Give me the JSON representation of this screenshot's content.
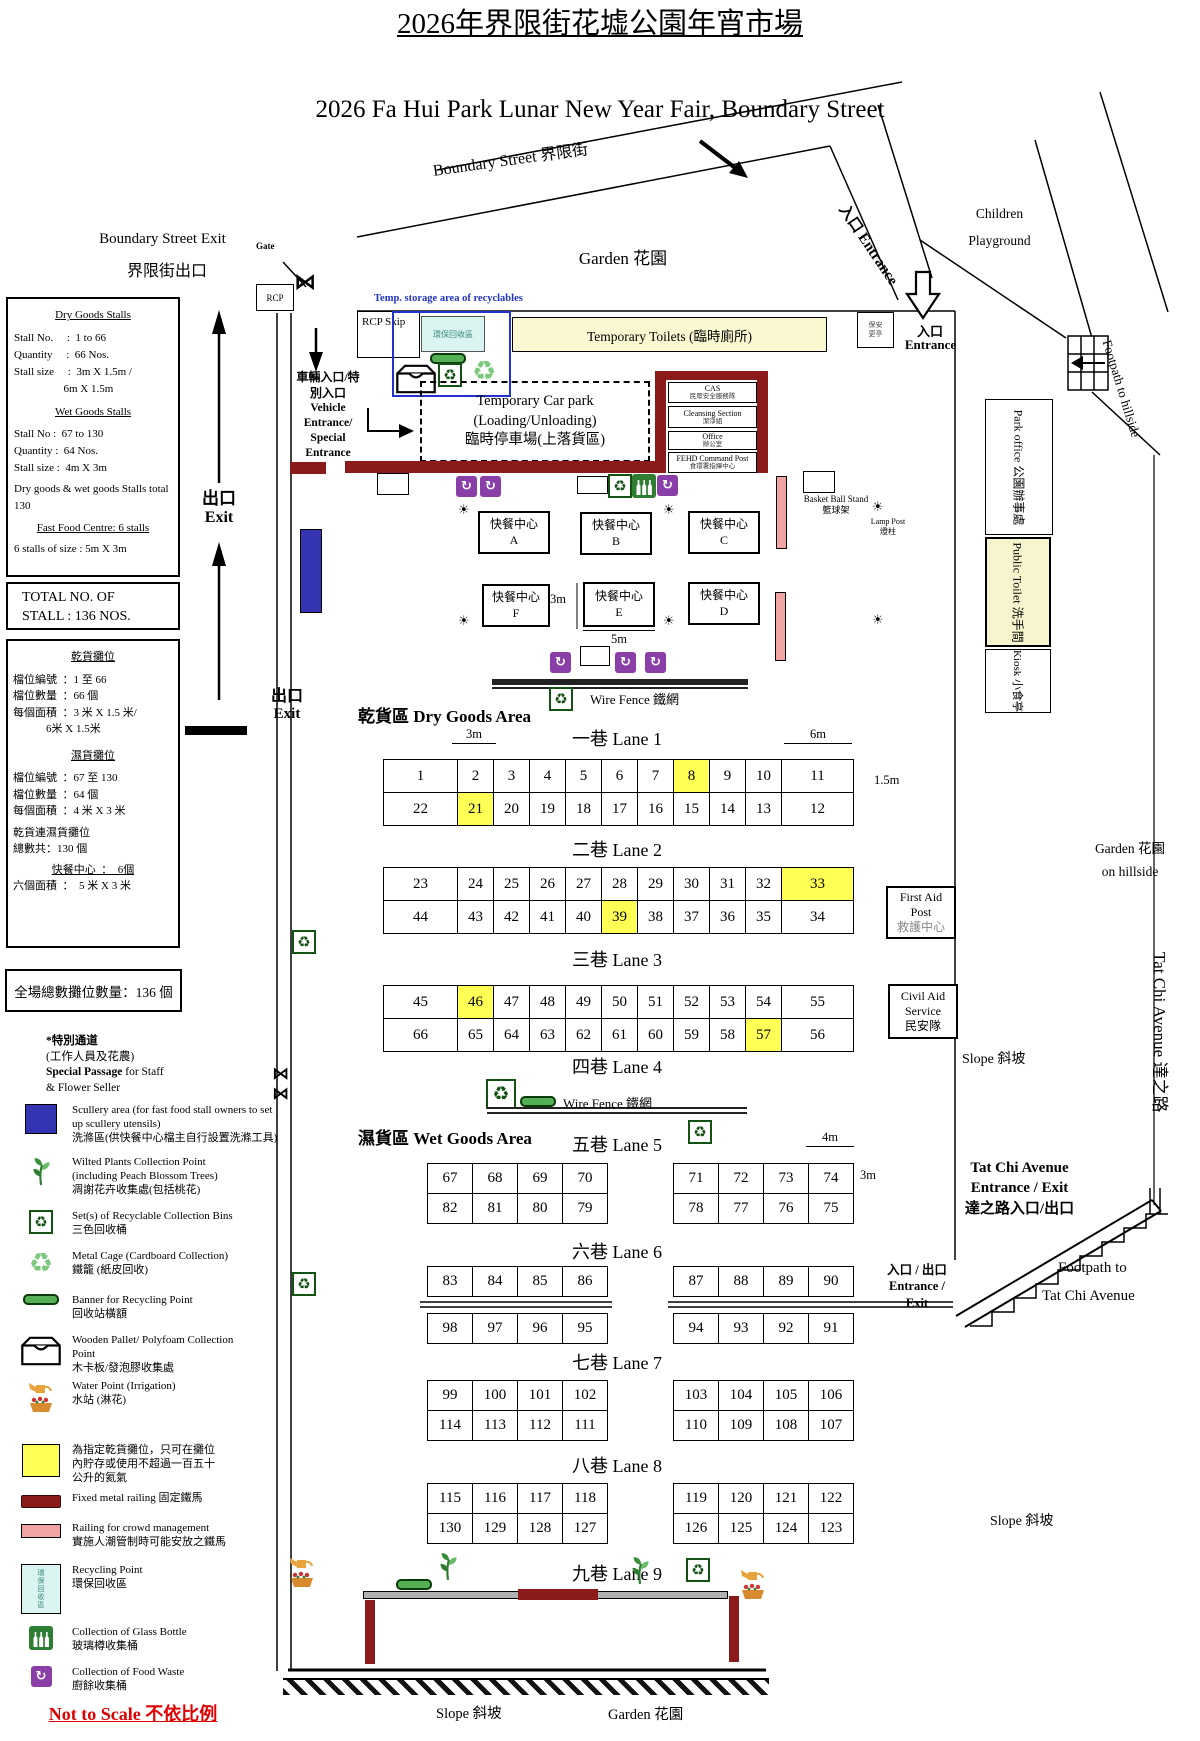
{
  "header": {
    "title_zh": "2026年界限街花墟公園年宵市場",
    "title_en": "2026 Fa Hui Park Lunar New Year Fair, Boundary Street"
  },
  "streets": {
    "boundary": "Boundary Street 界限街",
    "exit_en": "Boundary Street Exit",
    "exit_zh": "界限街出口",
    "gate": "Gate",
    "rcp": "RCP"
  },
  "left": {
    "dry_box": {
      "h1": "Dry Goods Stalls",
      "l1": "Stall No.     :  1 to 66",
      "l2": "Quantity     :  66 Nos.",
      "l3": "Stall size     :  3m X 1.5m /",
      "l4": "                  6m X 1.5m",
      "h2": "Wet Goods Stalls",
      "l5": "Stall No :  67 to 130",
      "l6": "Quantity :  64 Nos.",
      "l7": "Stall size :  4m X 3m",
      "l8": "Dry goods & wet goods Stalls total",
      "l9": "130",
      "h3": "Fast Food Centre: 6 stalls",
      "l10": "6 stalls of size : 5m X 3m"
    },
    "total_box": {
      "l1": "TOTAL NO. OF",
      "l2": "STALL : 136 NOS."
    },
    "zh_box": {
      "h1": "乾貨攤位",
      "l1": "檔位編號  ：1 至 66",
      "l2": "檔位數量  ：66 個",
      "l3": "每個面積  ：3 米 X 1.5 米/",
      "l4": "            6米 X 1.5米",
      "h2": "濕貨攤位",
      "l5": "檔位編號  ：67 至 130",
      "l6": "檔位數量  ：64 個",
      "l7": "每個面積  ：4 米 X 3 米",
      "l8": "乾貨連濕貨攤位",
      "l9": "總數共：130 個",
      "h3": "快餐中心  ：  6個",
      "l10": "六個面積  ：  5 米 X 3 米"
    },
    "grand_total": "全場總數攤位數量：136 個",
    "special": {
      "l1": "*特別通道",
      "l2": "(工作人員及花農)",
      "l3b": "Special Passage",
      "l3r": " for Staff",
      "l4": "& Flower Seller"
    },
    "legend": [
      {
        "icon": "scullery",
        "lines": [
          "Scullery area (for fast food stall owners to set",
          "up scullery utensils)",
          "洗滌區(供快餐中心檔主自行設置洗滌工具)"
        ]
      },
      {
        "icon": "plant",
        "lines": [
          "Wilted Plants Collection Point",
          "(including Peach Blossom Trees)",
          "凋謝花卉收集處(包括桃花)"
        ]
      },
      {
        "icon": "bins",
        "lines": [
          "Set(s) of Recyclable Collection Bins",
          "三色回收桶"
        ]
      },
      {
        "icon": "cage",
        "lines": [
          "Metal Cage (Cardboard Collection)",
          "鐵籠 (紙皮回收)"
        ]
      },
      {
        "icon": "banner",
        "lines": [
          "Banner for Recycling Point",
          "回收站橫額"
        ]
      },
      {
        "icon": "pallet",
        "lines": [
          "Wooden Pallet/ Polyfoam Collection",
          "Point",
          "木卡板/發泡膠收集處"
        ]
      },
      {
        "icon": "water",
        "lines": [
          "Water Point (Irrigation)",
          "水站 (淋花)"
        ]
      },
      {
        "icon": "yellow",
        "lines": [
          "為指定乾貨攤位，只可在攤位",
          "內貯存或使用不超過一百五十",
          "公升的氦氣"
        ]
      },
      {
        "icon": "railing-dark",
        "lines": [
          "Fixed metal railing 固定鐵馬"
        ]
      },
      {
        "icon": "railing-pink",
        "lines": [
          "Railing for crowd management",
          "實施人潮管制時可能安放之鐵馬"
        ]
      },
      {
        "icon": "recycling-point",
        "box_text": "環保回收區",
        "lines": [
          "Recycling Point",
          "環保回收區"
        ]
      },
      {
        "icon": "glass",
        "lines": [
          "Collection of Glass Bottle",
          "玻璃樽收集桶"
        ]
      },
      {
        "icon": "waste",
        "lines": [
          "Collection of Food Waste",
          "廚餘收集桶"
        ]
      }
    ],
    "not_to_scale": "Not to Scale 不依比例"
  },
  "exits": {
    "e1_zh": "出口",
    "e1_en": "Exit",
    "e2_zh": "出口",
    "e2_en": "Exit"
  },
  "map": {
    "temp_storage": "Temp. storage area of recyclables",
    "rcp_skip": "RCP Skip",
    "recycle_zone": "環保回收區",
    "garden": "Garden 花園",
    "toilets": "Temporary Toilets (臨時廁所)",
    "vehicle": {
      "z1": "車輛入口/特",
      "z2": "別入口",
      "e1": "Vehicle",
      "e2": "Entrance/",
      "e3": "Special",
      "e4": "Entrance"
    },
    "carpark": {
      "l1": "Temporary Car park",
      "l2": "(Loading/Unloading)",
      "l3": "臨時停車場(上落貨區)"
    },
    "cas": [
      {
        "en": "CAS",
        "zh": "民眾安全服務隊"
      },
      {
        "en": "Cleansing Section",
        "zh": "潔淨組"
      },
      {
        "en": "Office",
        "zh": "辦公室"
      },
      {
        "en": "FEHD Command Post",
        "zh": "食環署指揮中心"
      }
    ],
    "security": {
      "l1": "保安",
      "l2": "更亭"
    },
    "entrance_road": "入口 Entrance",
    "entrance": {
      "zh": "入口",
      "en": "Entrance"
    },
    "children": {
      "l1": "Children",
      "l2": "Playground"
    },
    "footpath_hillside": "Footpath to hillside",
    "park_office": "Park office 公園辦事處",
    "public_toilet": "Public Toilet 洗手間",
    "kiosk": "Kiosk 小食亭",
    "lamp_post": {
      "l1": "Lamp Post",
      "l2": "燈柱"
    },
    "basketball": {
      "l1": "Basket Ball Stand",
      "l2": "籃球架"
    },
    "first_aid": {
      "l1": "First Aid",
      "l2": "Post",
      "l3": "救護中心"
    },
    "civil_aid": {
      "l1": "Civil Aid",
      "l2": "Service",
      "l3": "民安隊"
    },
    "slope_a": "Slope 斜坡",
    "slope_b": "Slope 斜坡",
    "slope_c": "Slope 斜坡",
    "garden_hillside": {
      "l1": "Garden 花園",
      "l2": "on hillside"
    },
    "tatchi_entrance": {
      "l1": "Tat Chi Avenue",
      "l2": "Entrance / Exit",
      "l3": "達之路入口/出口"
    },
    "entrance_exit": {
      "l1": "入口 / 出口",
      "l2": "Entrance /",
      "l3": "Exit"
    },
    "footpath_tatchi": {
      "l1": "Footpath to",
      "l2": "Tat Chi Avenue"
    },
    "tatchi_vert": "Tat Chi Avenue 達之路",
    "dry_area": "乾貨區 Dry Goods Area",
    "wet_area": "濕貨區 Wet Goods Area",
    "wire_fence1": "Wire Fence 鐵網",
    "wire_fence2": "Wire Fence 鐵網",
    "garden_bottom": "Garden 花園",
    "dims": {
      "d3a": "3m",
      "d6": "6m",
      "d15": "1.5m",
      "d3f": "3m",
      "d5": "5m",
      "d4": "4m",
      "d3w": "3m"
    },
    "fast_food": [
      {
        "t": "快餐中心",
        "l": "A"
      },
      {
        "t": "快餐中心",
        "l": "B"
      },
      {
        "t": "快餐中心",
        "l": "C"
      },
      {
        "t": "快餐中心",
        "l": "F"
      },
      {
        "t": "快餐中心",
        "l": "E"
      },
      {
        "t": "快餐中心",
        "l": "D"
      }
    ]
  },
  "lanes": {
    "labels": [
      "一巷 Lane 1",
      "二巷 Lane 2",
      "三巷 Lane 3",
      "四巷 Lane 4",
      "五巷 Lane 5",
      "六巷 Lane 6",
      "七巷 Lane 7",
      "八巷 Lane 8",
      "九巷 Lane 9"
    ],
    "dry": [
      {
        "rows": [
          [
            "1",
            "2",
            "3",
            "4",
            "5",
            "6",
            "7",
            "8",
            "9",
            "10",
            "11"
          ],
          [
            "22",
            "21",
            "20",
            "19",
            "18",
            "17",
            "16",
            "15",
            "14",
            "13",
            "12"
          ]
        ],
        "yellow": [
          "8",
          "21"
        ]
      },
      {
        "rows": [
          [
            "23",
            "24",
            "25",
            "26",
            "27",
            "28",
            "29",
            "30",
            "31",
            "32",
            "33"
          ],
          [
            "44",
            "43",
            "42",
            "41",
            "40",
            "39",
            "38",
            "37",
            "36",
            "35",
            "34"
          ]
        ],
        "yellow": [
          "33",
          "39"
        ]
      },
      {
        "rows": [
          [
            "45",
            "46",
            "47",
            "48",
            "49",
            "50",
            "51",
            "52",
            "53",
            "54",
            "55"
          ],
          [
            "66",
            "65",
            "64",
            "63",
            "62",
            "61",
            "60",
            "59",
            "58",
            "57",
            "56"
          ]
        ],
        "yellow": [
          "46",
          "57"
        ]
      }
    ],
    "wet": [
      {
        "left": [
          [
            "67",
            "68",
            "69",
            "70"
          ],
          [
            "82",
            "81",
            "80",
            "79"
          ]
        ],
        "right": [
          [
            "71",
            "72",
            "73",
            "74"
          ],
          [
            "78",
            "77",
            "76",
            "75"
          ]
        ],
        "split": false
      },
      {
        "left": [
          [
            "83",
            "84",
            "85",
            "86"
          ],
          [
            "98",
            "97",
            "96",
            "95"
          ]
        ],
        "right": [
          [
            "87",
            "88",
            "89",
            "90"
          ],
          [
            "94",
            "93",
            "92",
            "91"
          ]
        ],
        "split": true
      },
      {
        "left": [
          [
            "99",
            "100",
            "101",
            "102"
          ],
          [
            "114",
            "113",
            "112",
            "111"
          ]
        ],
        "right": [
          [
            "103",
            "104",
            "105",
            "106"
          ],
          [
            "110",
            "109",
            "108",
            "107"
          ]
        ],
        "split": false
      },
      {
        "left": [
          [
            "115",
            "116",
            "117",
            "118"
          ],
          [
            "130",
            "129",
            "128",
            "127"
          ]
        ],
        "right": [
          [
            "119",
            "120",
            "121",
            "122"
          ],
          [
            "126",
            "125",
            "124",
            "123"
          ]
        ],
        "split": false
      }
    ]
  }
}
